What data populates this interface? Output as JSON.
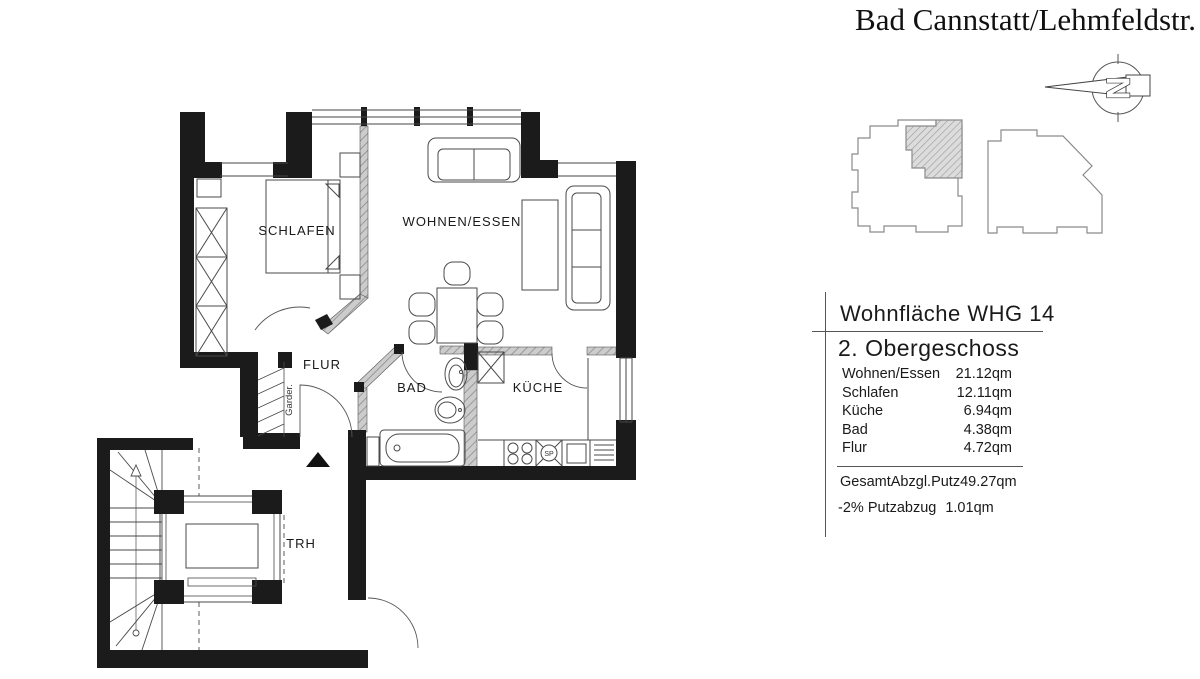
{
  "title": "Bad Cannstatt/Lehmfeldstr.",
  "north_arrow": {
    "letter": "N"
  },
  "info_panel": {
    "title": "Wohnfläche WHG 14",
    "subtitle": "2. Obergeschoss",
    "rows": [
      {
        "label": "Wohnen/Essen",
        "value": "21.12qm"
      },
      {
        "label": "Schlafen",
        "value": "12.11qm"
      },
      {
        "label": "Küche",
        "value": "6.94qm"
      },
      {
        "label": "Bad",
        "value": "4.38qm"
      },
      {
        "label": "Flur",
        "value": "4.72qm"
      }
    ],
    "total": {
      "label": "Gesamt",
      "sublabel": "Abzgl.Putz",
      "value": "49.27qm"
    },
    "deduction": {
      "label": "-2% Putzabzug",
      "value": "1.01qm"
    }
  },
  "floor_plan": {
    "labels": {
      "schlafen": "SCHLAFEN",
      "wohnen_essen": "WOHNEN/ESSEN",
      "flur": "FLUR",
      "bad": "BAD",
      "kueche": "KÜCHE",
      "trh": "TRH",
      "garderobe": "Garder.",
      "spuele": "SP"
    }
  },
  "colors": {
    "wall": "#1b1b1b",
    "line": "#4a4a4a",
    "light_wall": "#c9c9c9"
  }
}
